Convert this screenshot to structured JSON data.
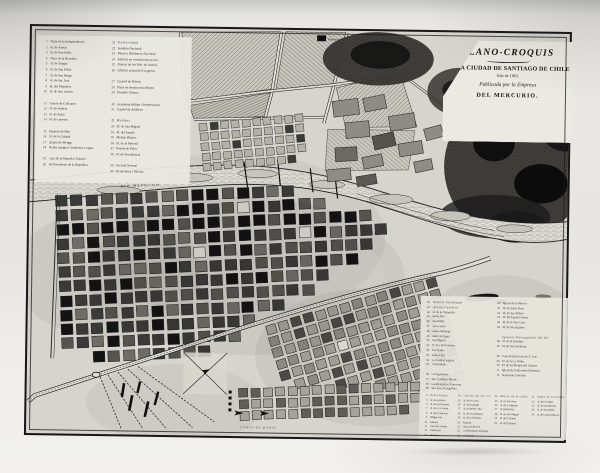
{
  "title_block": {
    "line1": "PLANO-CROQUIS",
    "line2": "DE LA CIUDAD DE SANTIAGO DE CHILE",
    "line3": "Año de 1863.",
    "line4": "Publicada por la Empresa",
    "line5": "DEL MERCURIO."
  },
  "map_labels": {
    "river": "RIO MAPOCHO",
    "campo_de_marte": "CAMPO DE MARTE",
    "panteon": "Panteon",
    "alameda": "Alameda de las Delicias"
  },
  "legend_top_left": {
    "col1": [
      {
        "n": "1",
        "t": "Plaza de la Independencia"
      },
      {
        "n": "2",
        "t": "Id. de Armas"
      },
      {
        "n": "3",
        "t": "Id. de San Isidro"
      },
      {
        "n": "4",
        "t": "Plaza de la Recoleta"
      },
      {
        "n": "5",
        "t": "Id. de Yungai"
      },
      {
        "n": "6",
        "t": "Id. de San Pablo"
      },
      {
        "n": "7",
        "t": "Id. de San Diego"
      },
      {
        "n": "8",
        "t": "Id. de Sta. Ana"
      },
      {
        "n": "9",
        "t": "Id. del Matadero"
      },
      {
        "n": "10",
        "t": "Id. de San Lazaro"
      },
      {
        "n": "",
        "t": ""
      },
      {
        "n": "11",
        "t": "Puente de Calicanto"
      },
      {
        "n": "12",
        "t": "Id. de madera"
      },
      {
        "n": "13",
        "t": "Id. de Palos"
      },
      {
        "n": "14",
        "t": "Id. de carretas"
      },
      {
        "n": "",
        "t": ""
      },
      {
        "n": "15",
        "t": "Tajamar del Rio"
      },
      {
        "n": "16",
        "t": "Id. de la Cañada"
      },
      {
        "n": "17",
        "t": "Quinta de Meiggs"
      },
      {
        "n": "18",
        "t": "Piedra antigua i fundicion a vapor",
        "h": 0
      },
      {
        "n": "",
        "t": ""
      },
      {
        "n": "19",
        "t": "Casa de la Moneda i Palacio"
      },
      {
        "n": "20",
        "t": "del Presidente de la Republica"
      }
    ],
    "col2": [
      {
        "n": "21",
        "t": "Universidad",
        "h": 1
      },
      {
        "n": "22",
        "t": "Instituto Nacional"
      },
      {
        "n": "23",
        "t": "Museo i Biblioteca Nacional"
      },
      {
        "n": "24",
        "t": "Edificio en construccion p.a la"
      },
      {
        "n": "25",
        "t": "Palacio de los Trib. de Justicia"
      },
      {
        "n": "26",
        "t": "Edificio actual del Congreso"
      },
      {
        "n": "",
        "t": ""
      },
      {
        "n": "27",
        "t": "Cuartel de Policia"
      },
      {
        "n": "28",
        "t": "Plaza de abastos mui Mayor"
      },
      {
        "n": "29",
        "t": "Presidio Urbano"
      },
      {
        "n": "",
        "t": ""
      },
      {
        "n": "30",
        "t": "Academia Militar i Penitenciaria"
      },
      {
        "n": "31",
        "t": "Cuartel de Artilleria"
      },
      {
        "n": "",
        "t": ""
      },
      {
        "n": "32",
        "t": "Molinos",
        "h": 1
      },
      {
        "n": "33",
        "t": "Id. de San Miguel"
      },
      {
        "n": "34",
        "t": "Id. del Estado"
      },
      {
        "n": "35",
        "t": "Molino Blanco"
      },
      {
        "n": "36",
        "t": "Id. de la Merced"
      },
      {
        "n": "37",
        "t": "Puente de Palos"
      },
      {
        "n": "38",
        "t": "Id. de Providencia"
      },
      {
        "n": "",
        "t": ""
      },
      {
        "n": "39",
        "t": "Escuela Normal"
      },
      {
        "n": "40",
        "t": "Id. de Artes i Oficios"
      }
    ]
  },
  "legend_bottom_right": {
    "col1": [
      {
        "n": "42",
        "t": "Palacio Arzobispal",
        "h": 1
      },
      {
        "n": "43",
        "t": "Iglesia Catedral",
        "h": 1
      },
      {
        "n": "44",
        "t": "Id. de la Compañia"
      },
      {
        "n": "45",
        "t": "Santa Ana"
      },
      {
        "n": "46",
        "t": "San Pablo"
      },
      {
        "n": "47",
        "t": "San Lazaro"
      },
      {
        "n": "48",
        "t": "Santo Domingo"
      },
      {
        "n": "49",
        "t": "Salto del Agua"
      },
      {
        "n": "50",
        "t": "San Miguel"
      },
      {
        "n": "51",
        "t": "N. Sra. del Carmen"
      },
      {
        "n": "52",
        "t": "San Pedro"
      },
      {
        "n": "53",
        "t": "Santa Clara"
      },
      {
        "n": "54",
        "t": "La Caridad inglesa"
      },
      {
        "n": "55",
        "t": "La Estampa"
      },
      {
        "n": "",
        "t": ""
      },
      {
        "n": "56",
        "t": "Las Agustinas"
      },
      {
        "n": "57",
        "t": "Sta. Catalina i Martir"
      },
      {
        "n": "58",
        "t": "Las Religiosas Francesas"
      },
      {
        "n": "59",
        "t": "San Juan Evangelista"
      }
    ],
    "col2": [
      {
        "n": "60",
        "t": "Iglesia de la Merced"
      },
      {
        "n": "61",
        "t": "Id. de Santa Rosa"
      },
      {
        "n": "62",
        "t": "Id. de San Rafael"
      },
      {
        "n": "63",
        "t": "Id. del Espiritu Santo"
      },
      {
        "n": "64",
        "t": "Id. de la Vera Cruz"
      },
      {
        "n": "65",
        "t": "Id. de San Agustin"
      },
      {
        "n": "",
        "t": ""
      },
      {
        "n": "",
        "t": "Iglesias Parroquiales del Sur",
        "h": 1
      },
      {
        "n": "66",
        "t": "Id. de la Estampa"
      },
      {
        "n": "67",
        "t": "Id. de San Saturnino"
      },
      {
        "n": "",
        "t": ""
      },
      {
        "n": "68",
        "t": "Casa de Ejercicios de S. Jose"
      },
      {
        "n": "69",
        "t": "Id. de la 3.a Orden"
      },
      {
        "n": "70",
        "t": "Id. de las Monjas del Carmen"
      },
      {
        "n": "71",
        "t": "Iglesia de la Recoleta Dominica"
      },
      {
        "n": "72",
        "t": "Seminario Conciliar"
      }
    ],
    "bottom_cols": [
      [
        {
          "n": "4",
          "t": "Hotel Ingles",
          "h": 1
        },
        {
          "n": "5",
          "t": "Id. de la Bolsa"
        },
        {
          "n": "6",
          "t": "Id. de las Posadas"
        },
        {
          "n": "7",
          "t": "Id. de la 3.a Serie"
        },
        {
          "n": "8",
          "t": "Id. del Comercio"
        },
        {
          "n": "9",
          "t": "Diligencias"
        },
        {
          "n": "10",
          "t": "Aduana"
        },
        {
          "n": "11",
          "t": "Casa de Correos"
        },
        {
          "n": "12",
          "t": "Asistencia"
        },
        {
          "n": "13",
          "t": "Matadero"
        }
      ],
      [
        {
          "n": "14",
          "t": "Capilla del Sto. Carmen",
          "h": 1
        },
        {
          "n": "15",
          "t": "Id. del Sr. Jose"
        },
        {
          "n": "16",
          "t": "Id. de Santiago"
        },
        {
          "n": "17",
          "t": "Id. de Belen i Sta."
        },
        {
          "n": "18",
          "t": "Id. de Sta. Barbara"
        },
        {
          "n": "19",
          "t": "Id. de la Veronica"
        },
        {
          "n": "20",
          "t": "Panteon"
        },
        {
          "n": "21",
          "t": "Salon de Recreo"
        },
        {
          "n": "22",
          "t": "La Maestranza Europea"
        },
        {
          "n": "23",
          "t": "La Florida"
        }
      ],
      [
        {
          "n": "24",
          "t": "Molino de la Cañadilla",
          "h": 1
        },
        {
          "n": "25",
          "t": "Id. de San Jose"
        },
        {
          "n": "26",
          "t": "Id. de la Aguada"
        },
        {
          "n": "27",
          "t": "Id. Bellavista"
        },
        {
          "n": "28",
          "t": "Id. de San Miguel"
        },
        {
          "n": "29",
          "t": "Id. del Carmen"
        },
        {
          "n": "30",
          "t": "Id. del Tajamar"
        }
      ],
      [
        {
          "n": "31",
          "t": "Baños de la Cañada",
          "h": 1
        },
        {
          "n": "32",
          "t": "Id. del Sr. Ruiz"
        },
        {
          "n": "33",
          "t": "Id. de las Delicias"
        },
        {
          "n": "34",
          "t": "Id. de San Pablo"
        },
        {
          "n": "35",
          "t": "Id. de la Providencia"
        }
      ]
    ]
  },
  "colors": {
    "ink": "#1b1b1b",
    "paper": "#d6d4cc",
    "photo_margin": "#e9e8e4"
  }
}
